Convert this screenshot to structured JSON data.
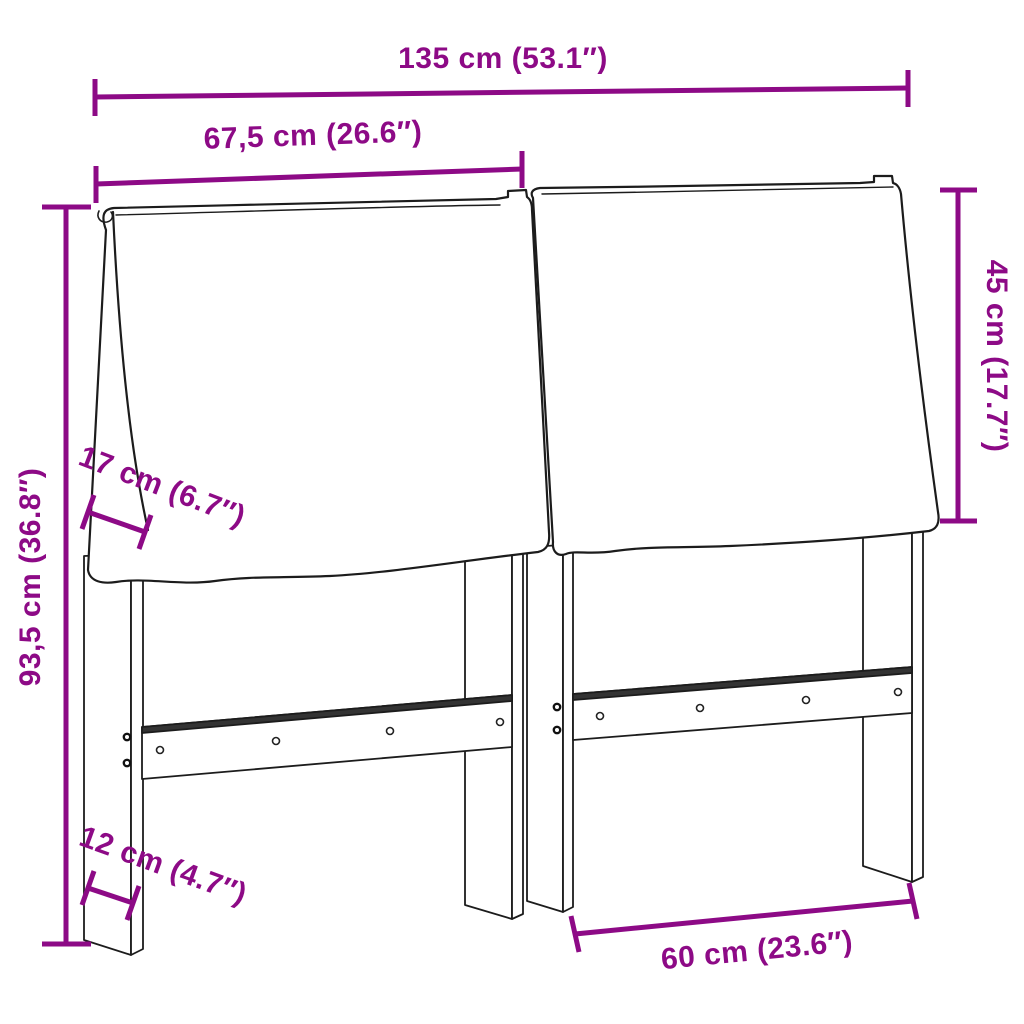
{
  "canvas": {
    "width": 1024,
    "height": 1024,
    "background": "#ffffff"
  },
  "style": {
    "accent_color": "#8d0a86",
    "line_color": "#1c1c1c"
  },
  "product": {
    "name": "headboard with two cushions, legs and mounting rails",
    "view": "front three-quarter line drawing"
  },
  "labels": {
    "total_width": "135 cm (53.1″)",
    "half_width": "67,5 cm (26.6″)",
    "cushion_height": "45 cm (17.7″)",
    "total_height": "93,5 cm (36.8″)",
    "cushion_thickness": "17 cm (6.7″)",
    "leg_depth": "12 cm (4.7″)",
    "leg_spacing": "60 cm (23.6″)"
  }
}
